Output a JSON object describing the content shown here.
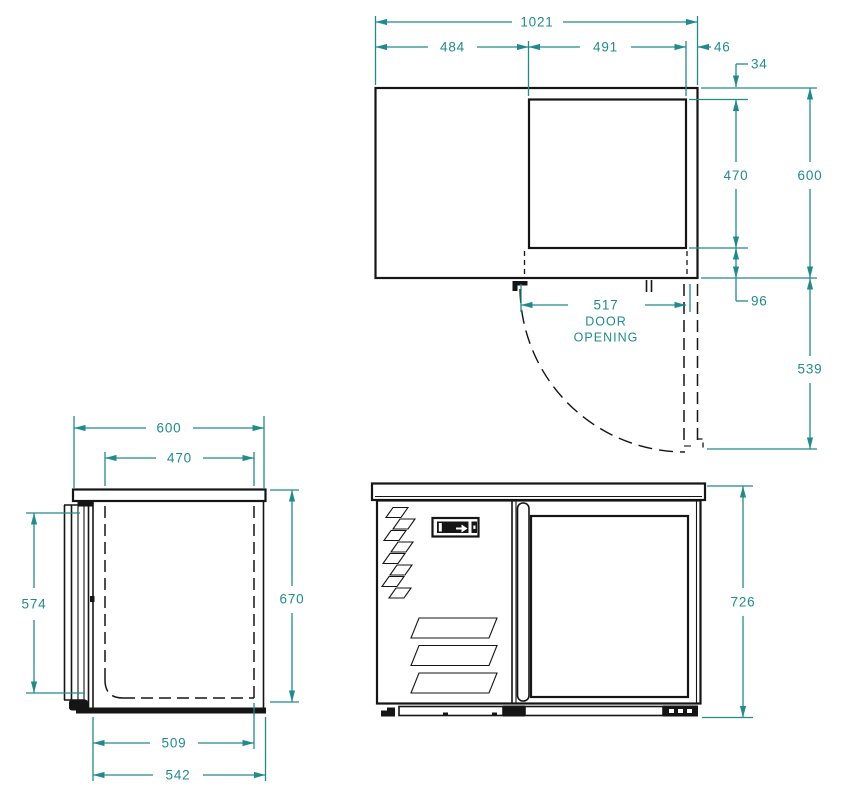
{
  "colors": {
    "dimension": "#208b8d",
    "ink": "#151515",
    "background": "#ffffff"
  },
  "top_view": {
    "overall_width": "1021",
    "left_section_width": "484",
    "door_panel_width": "491",
    "side_margin": "46",
    "back_inset": "34",
    "opening_depth": "470",
    "overall_depth": "600",
    "front_inset": "96",
    "door_swing_depth": "539",
    "door_opening_width": "517",
    "door_opening_word1": "DOOR",
    "door_opening_word2": "OPENING"
  },
  "side_view": {
    "overall_depth": "600",
    "opening_depth": "470",
    "door_height": "574",
    "body_height": "670",
    "inner_base_depth": "509",
    "base_depth": "542"
  },
  "front_view": {
    "overall_height": "726"
  }
}
